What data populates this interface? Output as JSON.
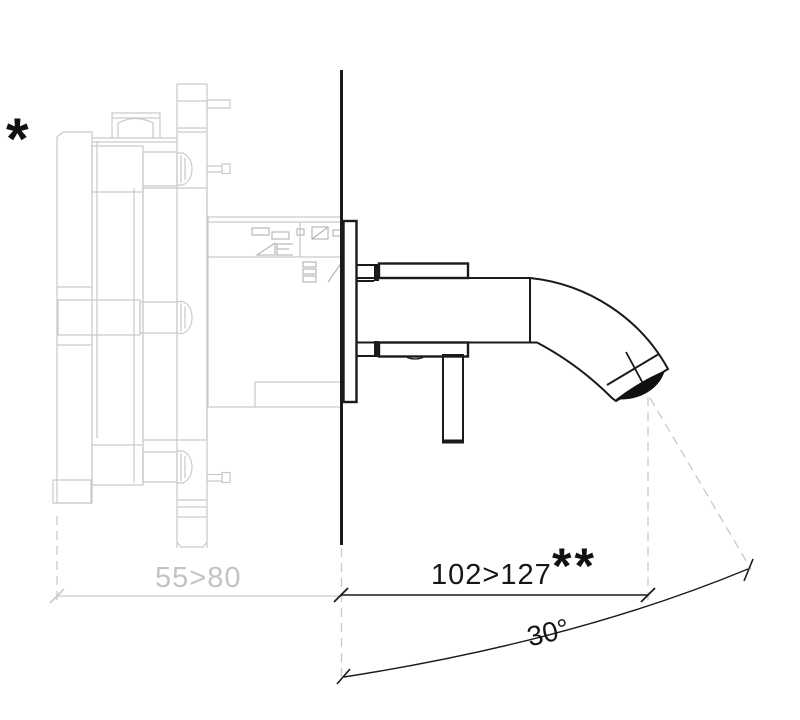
{
  "figure": {
    "footnote_marker": "*",
    "footnote_marker_double": "**",
    "labels": {
      "recess_depth": "55>80",
      "spout_projection": "102>127",
      "spray_angle": "30°"
    },
    "colors": {
      "line_black": "#1a1a1a",
      "line_gray": "#c9c9c9",
      "detail_gray": "#b2b2b2",
      "text_gray": "#c3c3c3",
      "background": "#ffffff"
    }
  }
}
